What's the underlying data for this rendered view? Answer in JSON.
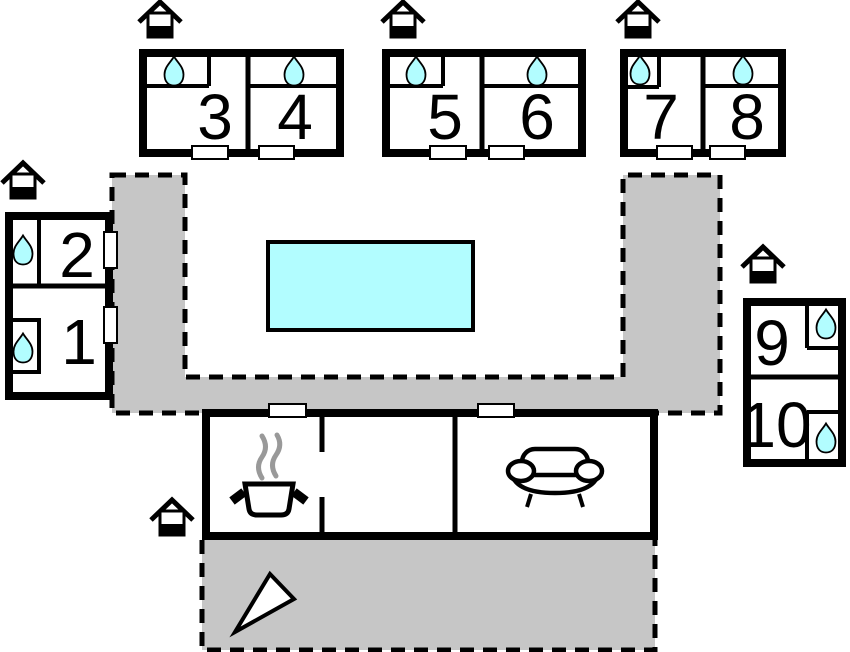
{
  "rooms": {
    "r1": "1",
    "r2": "2",
    "r3": "3",
    "r4": "4",
    "r5": "5",
    "r6": "6",
    "r7": "7",
    "r8": "8",
    "r9": "9",
    "r10": "10"
  },
  "colors": {
    "water": "#b2fdff",
    "terrace": "#c6c6c6",
    "wall": "#000000",
    "door": "#ffffff",
    "steam": "#999999",
    "north_arrow": "#ffffff"
  },
  "icons": {
    "entrance": "house-entrance-icon",
    "water": "water-drop-icon",
    "stove": "cooking-pot-icon",
    "sofa": "sofa-icon",
    "north_arrow": "north-arrow-icon",
    "pool": "swimming-pool"
  }
}
